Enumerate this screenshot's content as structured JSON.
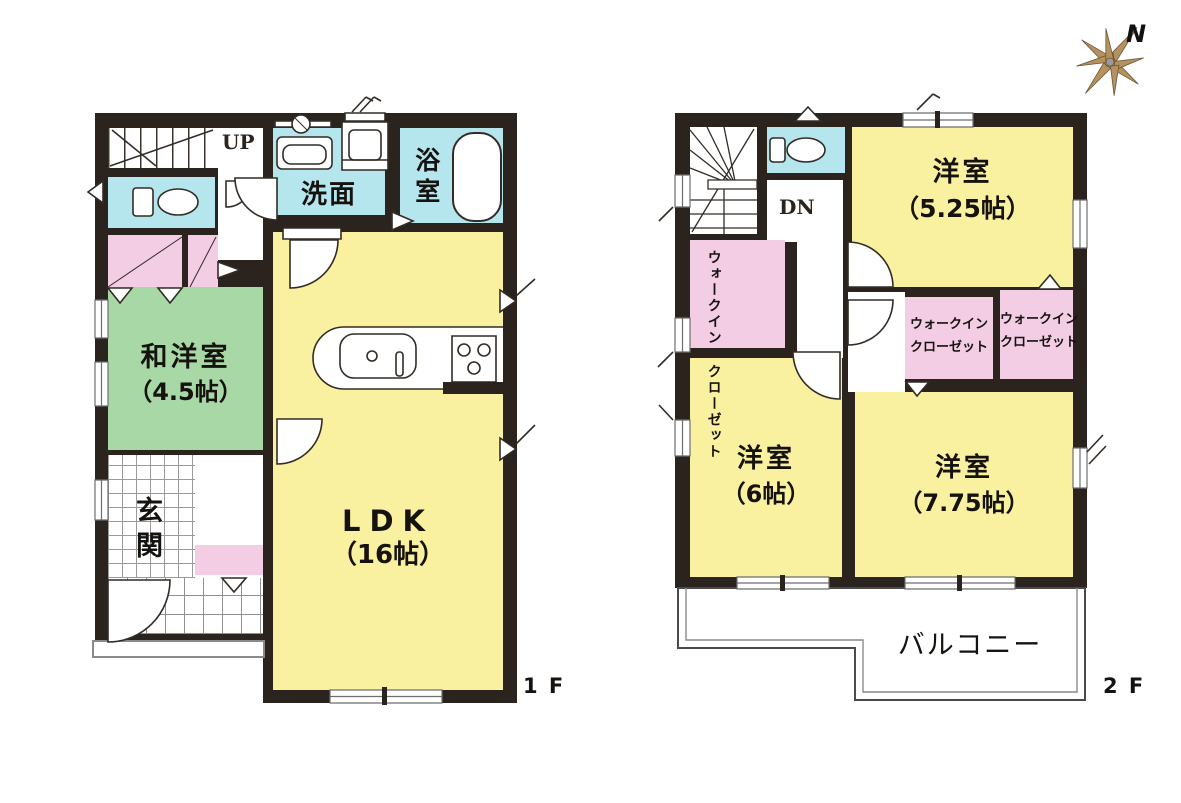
{
  "palette": {
    "wall": "#2a231e",
    "room_yellow": "#faf1a0",
    "room_green": "#a8d8a6",
    "room_cyan": "#b5e6ee",
    "closet_pink": "#f2cde4",
    "compass_tan": "#b3925f"
  },
  "compass": {
    "north_label": "N"
  },
  "floor1": {
    "floor_label": "1 F",
    "stairs_label": "UP",
    "rooms": {
      "washitsu": {
        "name": "和洋室",
        "size": "（4.5帖）"
      },
      "ldk": {
        "name": "LDK",
        "size": "（16帖）"
      },
      "genkan": {
        "name": "玄関"
      },
      "senmen": {
        "name": "洗面"
      },
      "bathroom": {
        "name": "浴室"
      }
    }
  },
  "floor2": {
    "floor_label": "2 F",
    "stairs_label": "DN",
    "rooms": {
      "bedroom_525": {
        "name": "洋室",
        "size": "（5.25帖）"
      },
      "bedroom_6": {
        "name": "洋室",
        "size": "（6帖）"
      },
      "bedroom_775": {
        "name": "洋室",
        "size": "（7.75帖）"
      },
      "wic_vertical": {
        "line1": "ウォークイン",
        "line2": "クローゼット"
      },
      "wic_center": {
        "line1": "ウォークイン",
        "line2": "クローゼット"
      },
      "wic_right": {
        "line1": "ウォークイン",
        "line2": "クローゼット"
      },
      "balcony": {
        "name": "バルコニー"
      }
    }
  }
}
